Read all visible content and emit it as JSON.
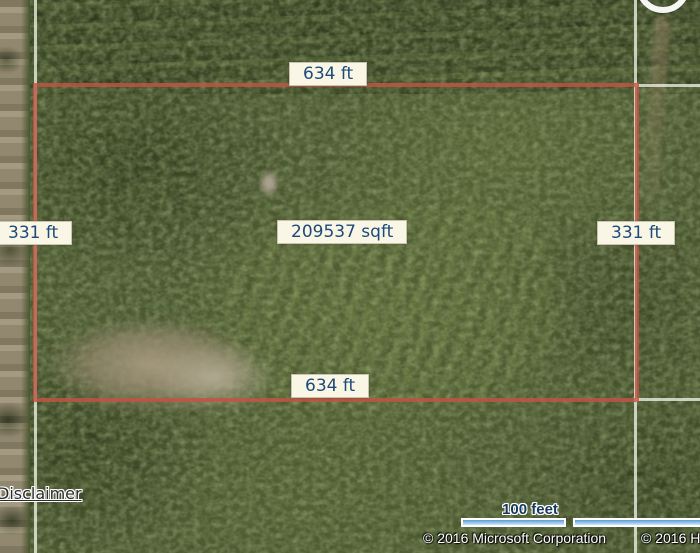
{
  "map": {
    "dimension_labels": {
      "top": "634 ft",
      "bottom": "634 ft",
      "left": "331 ft",
      "right": "331 ft"
    },
    "area_label": "209537 sqft"
  },
  "scale": {
    "label": "100 feet"
  },
  "attribution": {
    "microsoft": "© 2016 Microsoft Corporation",
    "partial_right": "© 2016 H"
  },
  "links": {
    "disclaimer": "Disclaimer"
  },
  "colors": {
    "parcel_outline": "#c15444",
    "boundary_line": "#e8eee0",
    "label_bg": "#faf6e6",
    "label_text": "#1c4a79",
    "scale_bar_fill": "#7fb6e3"
  }
}
